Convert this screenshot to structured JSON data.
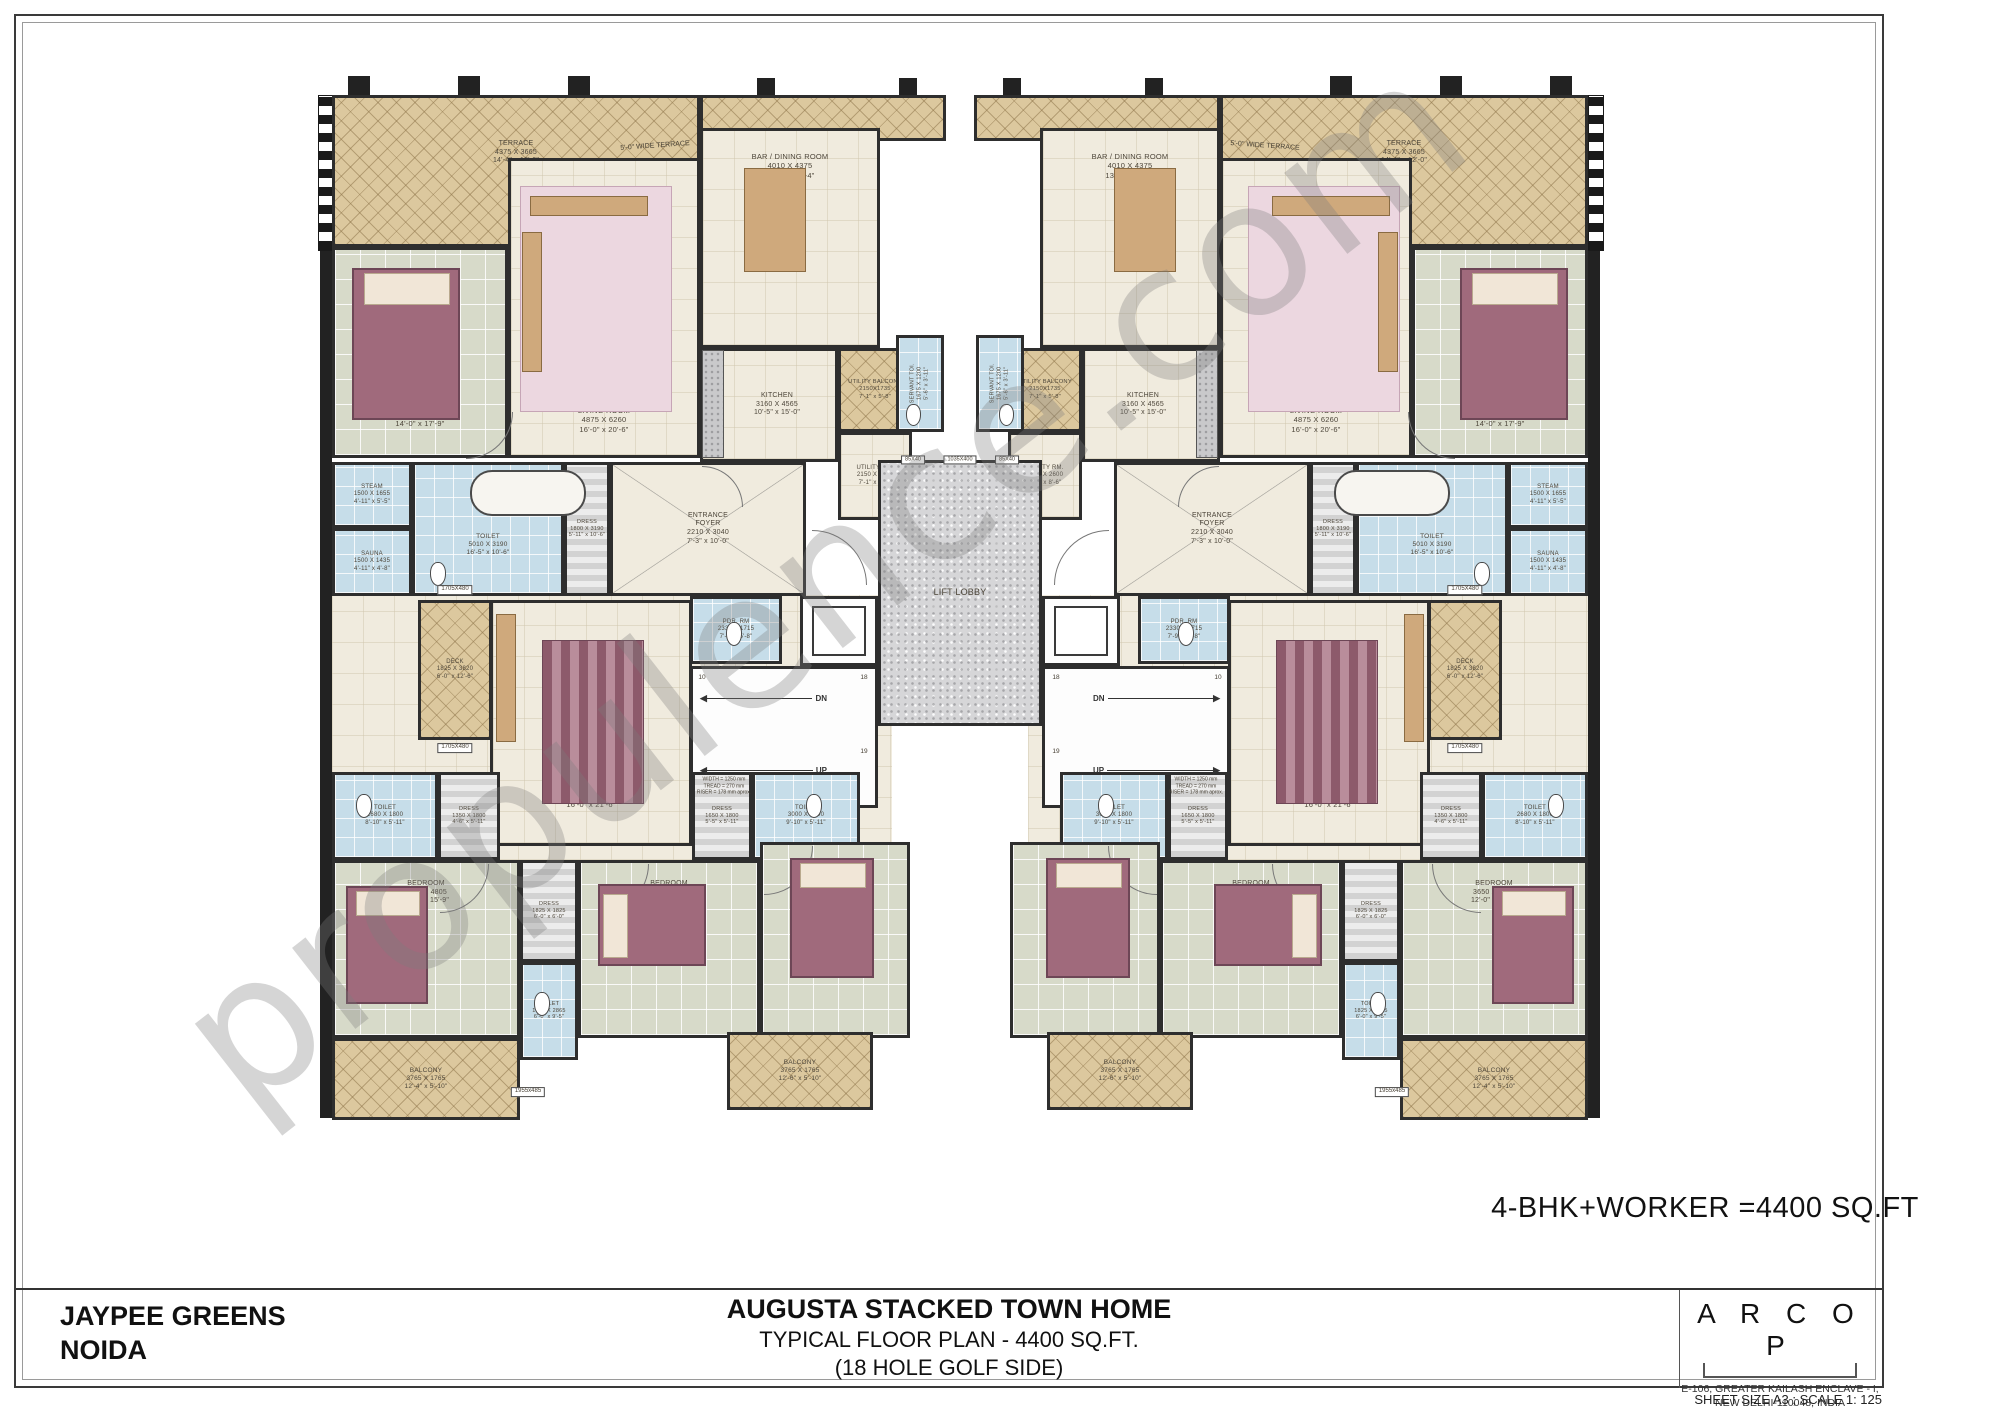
{
  "project": {
    "client_line1": "JAYPEE GREENS",
    "client_line2": "NOIDA",
    "title": "AUGUSTA STACKED TOWN HOME",
    "subtitle1": "TYPICAL FLOOR PLAN - 4400 SQ.FT.",
    "subtitle2": "(18 HOLE GOLF SIDE)",
    "area_note": "4-BHK+WORKER  =4400 SQ.FT",
    "architect": "A R C O P",
    "architect_address1": "E-106, GREATER KAILASH ENCLAVE - I,",
    "architect_address2": "NEW DELHI-110048, INDIA",
    "sheet_note": "SHEET SIZE A3 ; SCALE 1: 125",
    "watermark": "propulence.com"
  },
  "plan": {
    "axis": 960,
    "rooms": [
      {
        "id": "corridor",
        "x": 332,
        "y": 595,
        "w": 560,
        "h": 265,
        "fill": "cream",
        "noborder": true,
        "z": 0,
        "mirror": true
      },
      {
        "id": "terrace",
        "x": 332,
        "y": 95,
        "w": 368,
        "h": 152,
        "fill": "tan",
        "label": [
          "TERRACE",
          "4375 X 3665",
          "14'-4\" x 12'-0\""
        ],
        "ls": 7,
        "ldy": -18,
        "mirror": true
      },
      {
        "id": "terrace-strip",
        "x": 700,
        "y": 95,
        "w": 246,
        "h": 46,
        "fill": "tan",
        "mirror": true
      },
      {
        "id": "master-bed-room",
        "x": 332,
        "y": 247,
        "w": 176,
        "h": 211,
        "fill": "tile",
        "label": [
          "MASTER BED ROOM",
          "4260 X 5400",
          "14'-0\" x 17'-9\""
        ],
        "ls": 7.5,
        "ldy": 62,
        "mirror": true
      },
      {
        "id": "living-room",
        "x": 508,
        "y": 158,
        "w": 192,
        "h": 300,
        "fill": "cream",
        "label": [
          "LIVING ROOM",
          "4875 X 6260",
          "16'-0\" x 20'-6\""
        ],
        "ls": 7.5,
        "ldy": 112,
        "mirror": true
      },
      {
        "id": "bar-dining-room",
        "x": 700,
        "y": 128,
        "w": 180,
        "h": 220,
        "fill": "cream",
        "label": [
          "BAR / DINING ROOM",
          "4010 X 4375",
          "13'-2\" x 14'-4\""
        ],
        "ls": 7.5,
        "ldy": -72,
        "mirror": true
      },
      {
        "id": "kitchen",
        "x": 700,
        "y": 348,
        "w": 138,
        "h": 114,
        "fill": "cream",
        "label": [
          "KITCHEN",
          "3160 X 4565",
          "10'-5\" x 15'-0\""
        ],
        "ls": 7,
        "ldx": 8,
        "mirror": true
      },
      {
        "id": "utility-balcony",
        "x": 838,
        "y": 348,
        "w": 74,
        "h": 84,
        "fill": "tan",
        "label": [
          "UTILITY BALCONY",
          "2150X1735",
          "7'-1\" x 5'-8\""
        ],
        "ls": 5.8,
        "mirror": true
      },
      {
        "id": "servant-toilet",
        "x": 896,
        "y": 335,
        "w": 48,
        "h": 97,
        "fill": "blue",
        "label": [
          "SERVANT TOI.",
          "1675 X 1200",
          "5'-6\" x 3'-11\""
        ],
        "ls": 5.5,
        "vert": true,
        "mirror": true
      },
      {
        "id": "utility-room",
        "x": 838,
        "y": 432,
        "w": 74,
        "h": 88,
        "fill": "cream",
        "label": [
          "UTILITY RM.",
          "2150 X 2600",
          "7'-1\" x 8'-6\""
        ],
        "ls": 6,
        "mirror": true
      },
      {
        "id": "steam",
        "x": 332,
        "y": 462,
        "w": 80,
        "h": 66,
        "fill": "blue",
        "label": [
          "STEAM",
          "1500 X 1655",
          "4'-11\" x 5'-5\""
        ],
        "ls": 6,
        "mirror": true
      },
      {
        "id": "sauna",
        "x": 332,
        "y": 528,
        "w": 80,
        "h": 68,
        "fill": "blue",
        "label": [
          "SAUNA",
          "1500 X 1435",
          "4'-11\" x 4'-8\""
        ],
        "ls": 6,
        "mirror": true
      },
      {
        "id": "master-toilet",
        "x": 412,
        "y": 462,
        "w": 152,
        "h": 134,
        "fill": "blue",
        "label": [
          "TOILET",
          "5010 X 3190",
          "16'-5\" x 10'-6\""
        ],
        "ls": 6.5,
        "ldy": 16,
        "mirror": true
      },
      {
        "id": "master-dress",
        "x": 564,
        "y": 462,
        "w": 46,
        "h": 134,
        "fill": "stripes",
        "label": [
          "DRESS",
          "1800 X 3190",
          "5'-11\" x 10'-6\""
        ],
        "ls": 5.5,
        "mirror": true
      },
      {
        "id": "entrance-foyer",
        "x": 610,
        "y": 462,
        "w": 196,
        "h": 134,
        "fill": "cream",
        "cross": true,
        "label": [
          "ENTRANCE",
          "FOYER",
          "2210 X 3040",
          "7'-3\" x 10'-0\""
        ],
        "ls": 7,
        "mirror": true
      },
      {
        "id": "powder-room",
        "x": 690,
        "y": 596,
        "w": 92,
        "h": 68,
        "fill": "blue",
        "label": [
          "PDR. RM",
          "2330 X 1715",
          "7'-9\" x 5'-8\""
        ],
        "ls": 6,
        "mirror": true
      },
      {
        "id": "lift",
        "x": 800,
        "y": 596,
        "w": 78,
        "h": 70,
        "fill": "white",
        "label": [
          "LIFT",
          "1525 X 1600"
        ],
        "ls": 6.5,
        "mirror": true
      },
      {
        "id": "lift-lobby",
        "x": 878,
        "y": 460,
        "w": 164,
        "h": 266,
        "fill": "granite",
        "label": [
          "LIFT LOBBY"
        ],
        "ls": 9,
        "mirror": false
      },
      {
        "id": "staircase",
        "x": 690,
        "y": 666,
        "w": 188,
        "h": 142,
        "fill": "white",
        "stair": true,
        "mirror": true
      },
      {
        "id": "deck",
        "x": 418,
        "y": 600,
        "w": 74,
        "h": 140,
        "fill": "tan",
        "label": [
          "DECK",
          "1825 X 3820",
          "6'-0\" x 12'-6\""
        ],
        "ls": 6,
        "mirror": true
      },
      {
        "id": "family-lounge",
        "x": 490,
        "y": 600,
        "w": 202,
        "h": 246,
        "fill": "cream",
        "label": [
          "FAMILY LOUNGE",
          "4875 X 6565",
          "16'-0\" x 21'-6\""
        ],
        "ls": 7.5,
        "ldy": 72,
        "mirror": true
      },
      {
        "id": "toilet-left",
        "x": 332,
        "y": 772,
        "w": 106,
        "h": 88,
        "fill": "blue",
        "label": [
          "TOILET",
          "2680 X 1800",
          "8'-10\" x 5'-11\""
        ],
        "ls": 6,
        "mirror": true
      },
      {
        "id": "dress-left",
        "x": 438,
        "y": 772,
        "w": 62,
        "h": 88,
        "fill": "stripes",
        "label": [
          "DRESS",
          "1350 X 1800",
          "4'-6\" x 5'-11\""
        ],
        "ls": 5.5,
        "mirror": true
      },
      {
        "id": "dress-mid",
        "x": 692,
        "y": 772,
        "w": 60,
        "h": 88,
        "fill": "stripes",
        "label": [
          "DRESS",
          "1650 X 1800",
          "5'-5\" x 5'-11\""
        ],
        "ls": 5.5,
        "mirror": true
      },
      {
        "id": "toilet-mid",
        "x": 752,
        "y": 772,
        "w": 108,
        "h": 88,
        "fill": "blue",
        "label": [
          "TOILET",
          "3000 X 1800",
          "9'-10\" x 5'-11\""
        ],
        "ls": 6,
        "mirror": true
      },
      {
        "id": "bedroom-1",
        "x": 332,
        "y": 860,
        "w": 188,
        "h": 178,
        "fill": "tile",
        "label": [
          "BEDROOM",
          "3650 X 4805",
          "12'-0\" x 15'-9\""
        ],
        "ls": 7,
        "ldy": -56,
        "mirror": true
      },
      {
        "id": "dress-bed",
        "x": 520,
        "y": 860,
        "w": 58,
        "h": 102,
        "fill": "stripes",
        "label": [
          "DRESS",
          "1825 X 1825",
          "6'-0\" x 6'-0\""
        ],
        "ls": 5.5,
        "mirror": true
      },
      {
        "id": "toilet-bed",
        "x": 520,
        "y": 962,
        "w": 58,
        "h": 98,
        "fill": "blue",
        "label": [
          "TOILET",
          "1825 X 2865",
          "6'-0\" x 9'-5\""
        ],
        "ls": 5.5,
        "mirror": true
      },
      {
        "id": "bedroom-2",
        "x": 578,
        "y": 860,
        "w": 182,
        "h": 178,
        "fill": "tile",
        "label": [
          "BEDROOM",
          "3900 X 4805",
          "12'-10\" x 15'-9\""
        ],
        "ls": 7,
        "ldy": -56,
        "mirror": true
      },
      {
        "id": "bedroom-3",
        "x": 760,
        "y": 842,
        "w": 150,
        "h": 196,
        "fill": "tile",
        "label": [
          "BEDROOM",
          "3650 X 4805",
          "12'-0\" x 15'-9\""
        ],
        "ls": 7,
        "ldy": -62,
        "mirror": true
      },
      {
        "id": "balcony-1",
        "x": 332,
        "y": 1038,
        "w": 188,
        "h": 82,
        "fill": "tan",
        "label": [
          "BALCONY",
          "3765 X 1765",
          "12'-4\" x 5'-10\""
        ],
        "ls": 6.5,
        "mirror": true
      },
      {
        "id": "balcony-2",
        "x": 727,
        "y": 1032,
        "w": 146,
        "h": 78,
        "fill": "tan",
        "label": [
          "BALCONY",
          "3765 X 1765",
          "12'-6\" x 5'-10\""
        ],
        "ls": 6.5,
        "mirror": true
      }
    ],
    "texts": [
      {
        "id": "wide-terrace-note",
        "x": 655,
        "y": 146,
        "lines": [
          "5'-0\" WIDE TERRACE"
        ],
        "ls": 7,
        "rot": -4,
        "mirror": true
      },
      {
        "id": "planter-top",
        "x": 455,
        "y": 590,
        "lines": [
          "1705X480"
        ],
        "ls": 6,
        "boxed": true,
        "mirror": true
      },
      {
        "id": "planter-bottom",
        "x": 455,
        "y": 748,
        "lines": [
          "1705X480"
        ],
        "ls": 6,
        "boxed": true,
        "mirror": true
      },
      {
        "id": "ledge",
        "x": 528,
        "y": 1092,
        "lines": [
          "1955x485"
        ],
        "ls": 6,
        "boxed": true,
        "mirror": true
      },
      {
        "id": "stair-num-10",
        "x": 702,
        "y": 678,
        "lines": [
          "10"
        ],
        "ls": 6.5,
        "mirror": true
      },
      {
        "id": "stair-num-18",
        "x": 864,
        "y": 678,
        "lines": [
          "18"
        ],
        "ls": 6.5,
        "mirror": true
      },
      {
        "id": "stair-num-19",
        "x": 864,
        "y": 752,
        "lines": [
          "19"
        ],
        "ls": 6.5,
        "mirror": true
      },
      {
        "id": "stair-note",
        "x": 724,
        "y": 786,
        "lines": [
          "WIDTH = 1250 mm",
          "TREAD = 270 mm",
          "RISER = 178 mm aprox."
        ],
        "ls": 5,
        "mirror": true
      },
      {
        "id": "shaft-a",
        "x": 913,
        "y": 460,
        "lines": [
          "85X40"
        ],
        "ls": 5.5,
        "boxed": true,
        "mirror": false
      },
      {
        "id": "shaft-b",
        "x": 960,
        "y": 460,
        "lines": [
          "1035X400"
        ],
        "ls": 5.5,
        "boxed": true,
        "mirror": false
      },
      {
        "id": "shaft-c",
        "x": 1007,
        "y": 460,
        "lines": [
          "85X40"
        ],
        "ls": 5.5,
        "boxed": true,
        "mirror": false
      }
    ],
    "arrows": [
      {
        "id": "stair-dn",
        "x": 700,
        "y": 698,
        "len": 130,
        "label": "DN",
        "mirror": true
      },
      {
        "id": "stair-up",
        "x": 700,
        "y": 770,
        "len": 130,
        "label": "UP",
        "mirror": true
      }
    ],
    "piers": [
      {
        "x": 320,
        "y": 249,
        "w": 12,
        "h": 869,
        "mirror": true
      },
      {
        "x": 348,
        "y": 76,
        "w": 22,
        "h": 26,
        "mirror": true
      },
      {
        "x": 458,
        "y": 76,
        "w": 22,
        "h": 26,
        "mirror": true
      },
      {
        "x": 568,
        "y": 76,
        "w": 22,
        "h": 26,
        "mirror": true
      },
      {
        "x": 757,
        "y": 78,
        "w": 18,
        "h": 22,
        "mirror": true
      },
      {
        "x": 899,
        "y": 78,
        "w": 18,
        "h": 22,
        "mirror": true
      }
    ],
    "checkers": [
      {
        "x": 318,
        "y": 95,
        "w": 14,
        "h": 154,
        "mirror": true
      }
    ],
    "arcs": [
      {
        "x": 466,
        "y": 412,
        "r": 46,
        "c": "br",
        "mirror": true
      },
      {
        "x": 812,
        "y": 530,
        "r": 54,
        "c": "tr",
        "mirror": true
      },
      {
        "x": 702,
        "y": 466,
        "r": 40,
        "c": "tr",
        "mirror": true
      },
      {
        "x": 440,
        "y": 864,
        "r": 48,
        "c": "br",
        "mirror": true
      },
      {
        "x": 600,
        "y": 864,
        "r": 48,
        "c": "br",
        "mirror": true
      },
      {
        "x": 764,
        "y": 846,
        "r": 48,
        "c": "br",
        "mirror": true
      }
    ],
    "furniture": [
      {
        "type": "bed",
        "x": 352,
        "y": 268,
        "w": 108,
        "h": 152,
        "mirror": true
      },
      {
        "type": "bed",
        "x": 346,
        "y": 886,
        "w": 82,
        "h": 118,
        "mirror": true
      },
      {
        "type": "bed",
        "x": 598,
        "y": 884,
        "w": 108,
        "h": 82,
        "side": true,
        "mirror": true
      },
      {
        "type": "bed",
        "x": 790,
        "y": 858,
        "w": 84,
        "h": 120,
        "mirror": true
      },
      {
        "type": "rugpink",
        "x": 520,
        "y": 186,
        "w": 152,
        "h": 226,
        "mirror": true
      },
      {
        "type": "wood",
        "x": 530,
        "y": 196,
        "w": 118,
        "h": 20,
        "mirror": true
      },
      {
        "type": "wood",
        "x": 522,
        "y": 232,
        "w": 20,
        "h": 140,
        "mirror": true
      },
      {
        "type": "rugstripe",
        "x": 542,
        "y": 640,
        "w": 102,
        "h": 164,
        "mirror": true
      },
      {
        "type": "wood",
        "x": 496,
        "y": 614,
        "w": 20,
        "h": 128,
        "mirror": true
      },
      {
        "type": "tub",
        "x": 470,
        "y": 470,
        "w": 116,
        "h": 46,
        "mirror": true
      },
      {
        "type": "wood",
        "x": 744,
        "y": 168,
        "w": 62,
        "h": 104,
        "mirror": true
      },
      {
        "type": "counter",
        "x": 702,
        "y": 350,
        "w": 22,
        "h": 108,
        "mirror": true
      },
      {
        "type": "liftcar",
        "x": 812,
        "y": 606,
        "w": 54,
        "h": 50,
        "mirror": true
      },
      {
        "type": "wc",
        "x": 430,
        "y": 562,
        "w": 16,
        "h": 24,
        "mirror": true
      },
      {
        "type": "wc",
        "x": 726,
        "y": 622,
        "w": 16,
        "h": 24,
        "mirror": true
      },
      {
        "type": "wc",
        "x": 356,
        "y": 794,
        "w": 16,
        "h": 24,
        "mirror": true
      },
      {
        "type": "wc",
        "x": 806,
        "y": 794,
        "w": 16,
        "h": 24,
        "mirror": true
      },
      {
        "type": "wc",
        "x": 534,
        "y": 992,
        "w": 16,
        "h": 24,
        "mirror": true
      },
      {
        "type": "wc",
        "x": 906,
        "y": 404,
        "w": 15,
        "h": 22,
        "mirror": true
      }
    ]
  }
}
